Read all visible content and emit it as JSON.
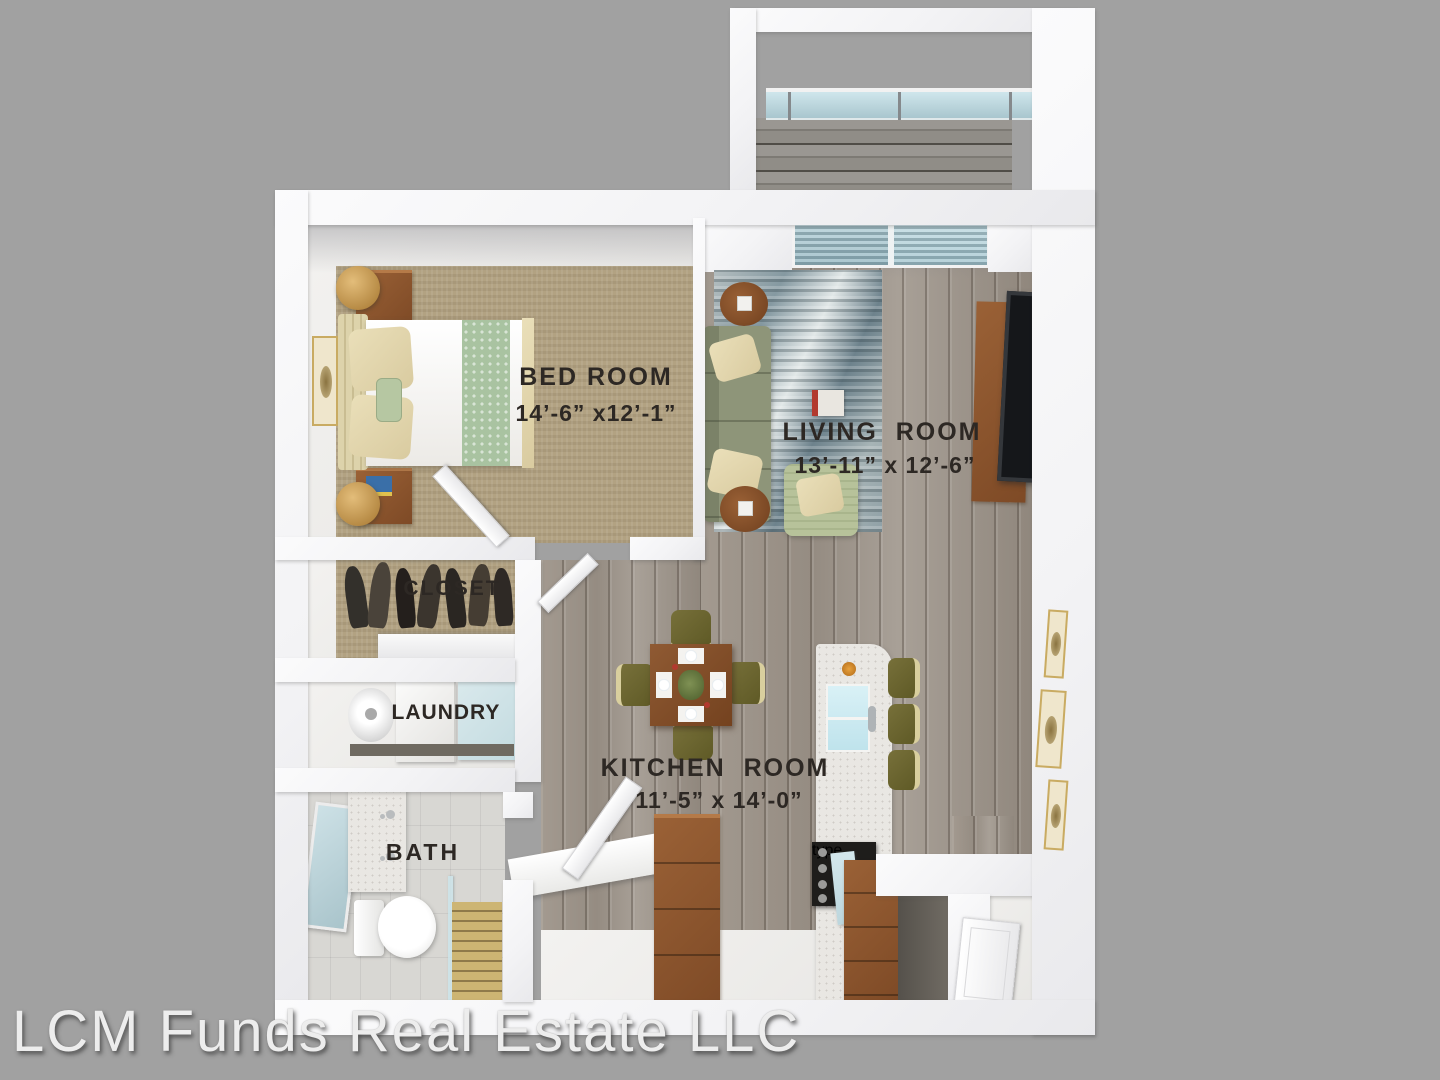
{
  "scene": {
    "type": "3d-floor-plan-top-view",
    "description": "Rendered one-bedroom apartment floor plan",
    "background_color": "#a1a1a1"
  },
  "watermark": {
    "text": "LCM Funds Real Estate LLC"
  },
  "rooms": {
    "bedroom": {
      "label": "BED ROOM",
      "dimensions": "14’-6” x12’-1”"
    },
    "living_room": {
      "label": "LIVING  ROOM",
      "dimensions": "13’-11” x 12’-6”"
    },
    "kitchen": {
      "label": "KITCHEN  ROOM",
      "dimensions": "11’-5” x 14’-0”"
    },
    "closet": {
      "label": "CLOSET"
    },
    "laundry": {
      "label": "LAUNDRY"
    },
    "bath": {
      "label": "BATH"
    }
  },
  "colors": {
    "background": "#a1a1a1",
    "wall": "#f6f6f8",
    "wood_floor": "#9b9187",
    "bedroom_carpet": "#b2a282",
    "bath_tile": "#d8d7d3",
    "rug": "#8fa0a6",
    "sofa_green": "#8e9579",
    "armchair_green": "#b7c29a",
    "furniture_wood": "#8a5430",
    "chair_olive": "#6c6630",
    "island_marble": "#e9e7e3",
    "sink_blue": "#cfeef5",
    "window_glass": "#a9c6ce",
    "label_text": "#2d2824",
    "watermark_text": "#ededed",
    "gold_accent": "#c79a4b"
  }
}
